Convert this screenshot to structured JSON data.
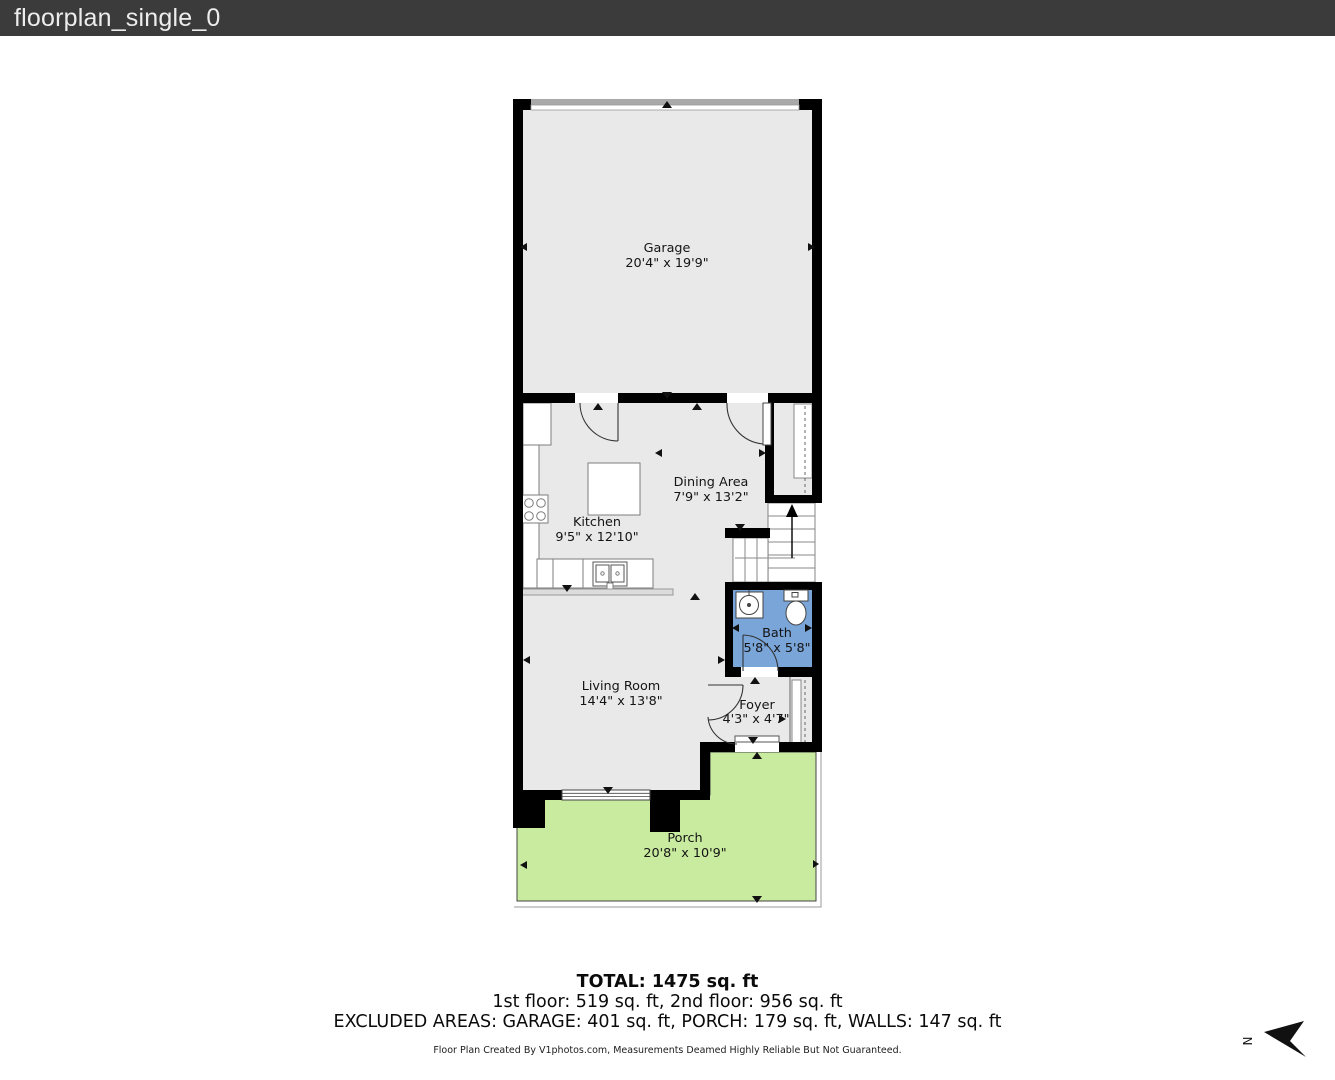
{
  "header": {
    "title": "floorplan_single_0"
  },
  "rooms": [
    {
      "name": "Garage",
      "dims": "20'4\" x 19'9\""
    },
    {
      "name": "Kitchen",
      "dims": "9'5\" x 12'10\""
    },
    {
      "name": "Dining Area",
      "dims": "7'9\" x 13'2\""
    },
    {
      "name": "Bath",
      "dims": "5'8\" x 5'8\""
    },
    {
      "name": "Living Room",
      "dims": "14'4\" x 13'8\""
    },
    {
      "name": "Foyer",
      "dims": "4'3\" x 4'7\""
    },
    {
      "name": "Porch",
      "dims": "20'8\" x 10'9\""
    }
  ],
  "summary": {
    "total": "TOTAL: 1475 sq. ft",
    "floors": "1st floor: 519 sq. ft, 2nd floor: 956 sq. ft",
    "excluded": "EXCLUDED AREAS: GARAGE: 401 sq. ft, PORCH: 179 sq. ft, WALLS: 147 sq. ft"
  },
  "footer": {
    "credit": "Floor Plan Created By V1photos.com, Measurements Deamed Highly Reliable But Not Guaranteed."
  },
  "compass": {
    "label": "N"
  },
  "colors": {
    "header_bg": "#3b3b3b",
    "wall": "#000000",
    "floor": "#e9e9e9",
    "bath": "#79a5d8",
    "porch": "#c9eb9f",
    "garage_door": "#a9a9a9"
  }
}
